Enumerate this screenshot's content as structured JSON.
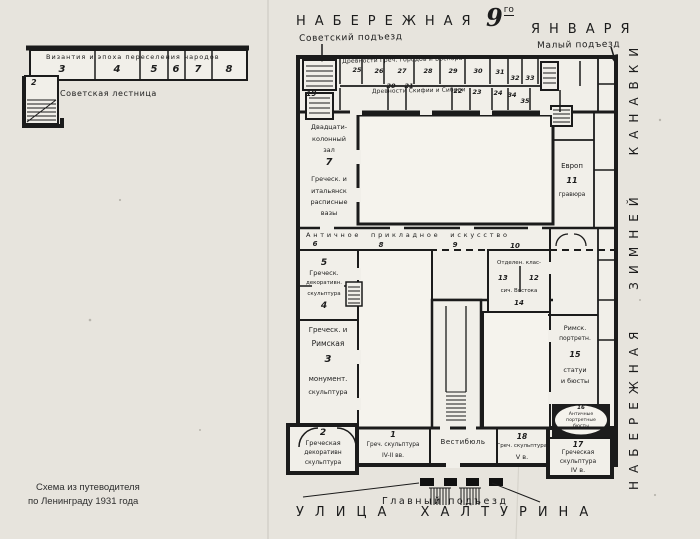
{
  "streets": {
    "top_embankment": "НАБЕРЕЖНАЯ",
    "date_number": "9",
    "date_suffix": "го",
    "top_january": "ЯНВАРЯ",
    "bottom_street": "УЛИЦА ХАЛТУРИНА",
    "right_embankment": "НАБЕРЕЖНАЯ ЗИМНЕЙ КАНАВКИ"
  },
  "entrances": {
    "soviet": "Советский подъезд",
    "small": "Малый подъезд",
    "main": "Главный подъезд"
  },
  "inset": {
    "title": "Византия и эпоха переселения народов",
    "rooms": [
      "3",
      "4",
      "5",
      "6",
      "7",
      "8"
    ],
    "room_2": "2",
    "staircase_label": "Советская лестница"
  },
  "gallery": {
    "row1_label": "Древности Греч. городов и Боспора",
    "row1_rooms": [
      "25",
      "26",
      "27",
      "28",
      "29",
      "30",
      "31",
      "32",
      "33"
    ],
    "row2_label": "Древности Скифии и Сибири",
    "room_19": "19",
    "row2_rooms": [
      "20",
      "21",
      "22",
      "23",
      "24",
      "34",
      "35"
    ]
  },
  "corridor": {
    "label": "Античное прикладное искусство",
    "room_6": "6",
    "room_8": "8",
    "room_9": "9",
    "room_10": "10"
  },
  "west_wing": {
    "hall20": [
      "Двадцати-",
      "колонный",
      "зал",
      "7",
      "Греческ. и",
      "итальянск",
      "расписные",
      "вазы"
    ],
    "r5_4": [
      "5",
      "Греческ.",
      "декоративн.",
      "скульптура",
      "4"
    ],
    "r3": [
      "Греческ. и",
      "Римская",
      "3",
      "монумент.",
      "скульптура"
    ],
    "r2": [
      "2",
      "Греческая",
      "декоративн",
      "скульптура"
    ]
  },
  "east_wing": {
    "r11": [
      "Европ",
      "11",
      "гравюра"
    ],
    "r12_14": [
      "Отделен. клас-",
      "13",
      "12",
      "сич. Востока",
      "14"
    ],
    "r15": [
      "Римск.",
      "портретн.",
      "15",
      "статуи",
      "и бюсты"
    ],
    "r16": [
      "16",
      "Античные",
      "портретные",
      "бюсты"
    ],
    "r17": [
      "17",
      "Греческая",
      "скульптура",
      "IV в."
    ]
  },
  "south_band": {
    "r1": [
      "1",
      "Греч. скульптура",
      "IV-II вв."
    ],
    "vestibule": "Вестибюль",
    "r18": [
      "18",
      "Греч. скульптура",
      "V в."
    ]
  },
  "caption": {
    "line1": "Схема из путеводителя",
    "line2": "по Ленинграду 1931 года"
  }
}
